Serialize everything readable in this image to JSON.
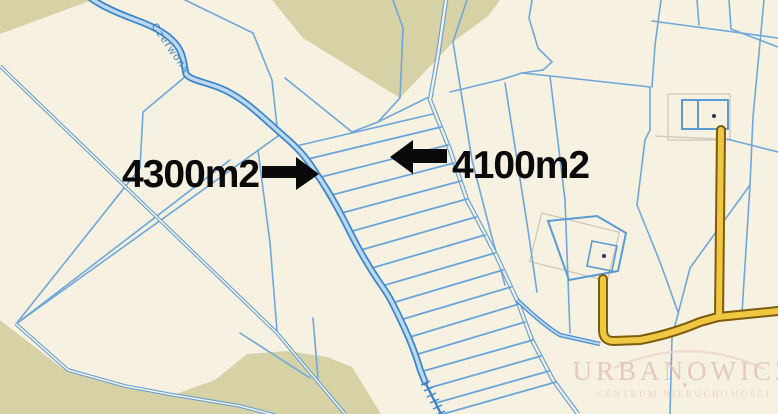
{
  "map": {
    "background_color": "#f7f1e1",
    "forest_color": "#d6d2a6",
    "parcel_line_color": "#6fa7da",
    "ditch_line_color": "#5b9bd5",
    "stream": {
      "name": "Czerwona",
      "label_color": "#3f7fc4",
      "casing_color": "#3e87cb",
      "water_color": "#bdd9f1"
    },
    "road": {
      "fill_color": "#f0c741",
      "casing_color": "#7d5c0d"
    },
    "annotations": [
      {
        "label": "4300m2",
        "arrow_direction": "right",
        "color": "#0a0a0a"
      },
      {
        "label": "4100m2",
        "arrow_direction": "left",
        "color": "#0a0a0a"
      }
    ],
    "watermark": {
      "title": "URBANOWICZ",
      "subtitle": "CENTRUM NIERUCHOMOŚCI",
      "color": "#e0bfb2"
    }
  }
}
